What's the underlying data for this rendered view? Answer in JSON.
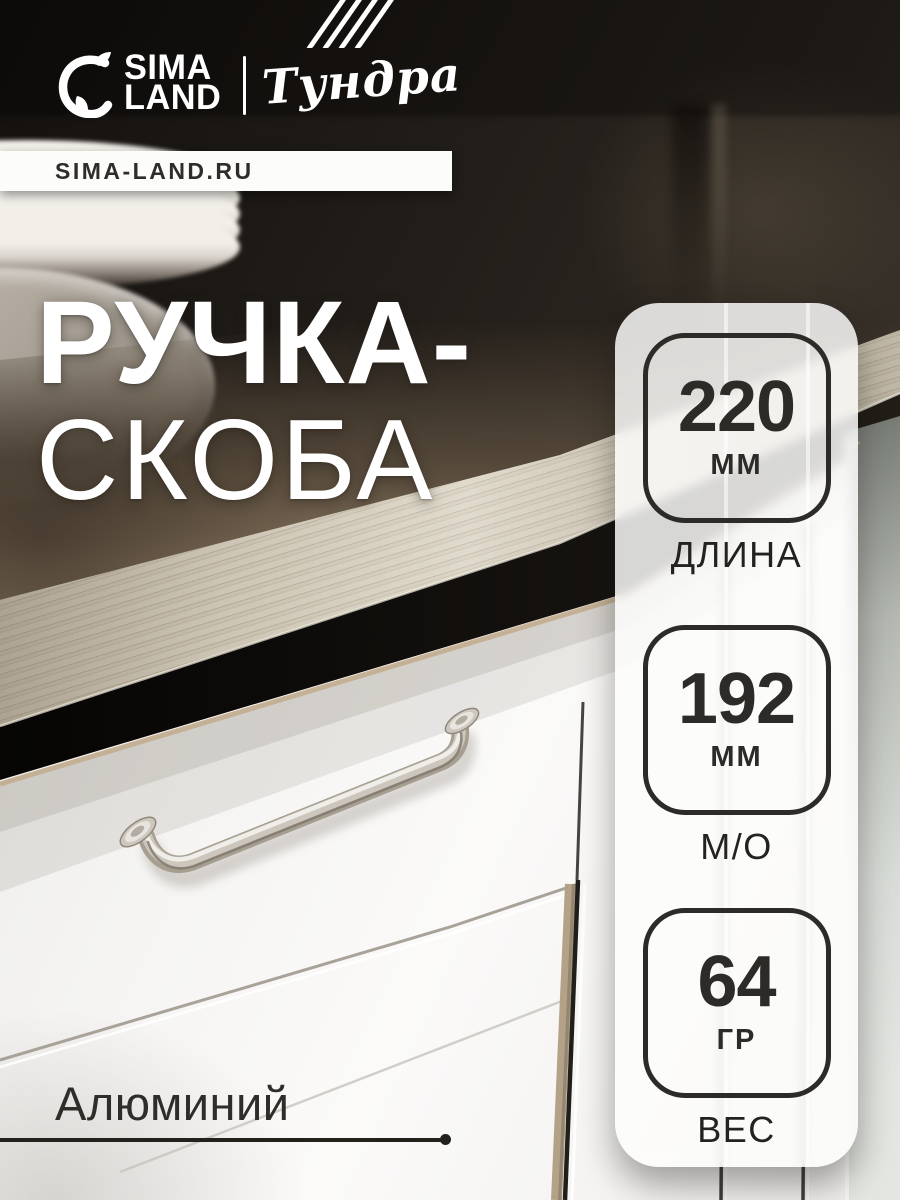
{
  "brand": {
    "logo_line1": "SIMA",
    "logo_line2": "LAND",
    "partner_brand": "Тундра",
    "website": "SIMA-LAND.RU"
  },
  "product": {
    "title_line1": "РУЧКА-",
    "title_line2": "СКОБА",
    "material_label": "Алюминий"
  },
  "specs": [
    {
      "value": "220",
      "unit": "ММ",
      "label": "ДЛИНА"
    },
    {
      "value": "192",
      "unit": "ММ",
      "label": "М/О"
    },
    {
      "value": "64",
      "unit": "ГР",
      "label": "ВЕС"
    }
  ],
  "colors": {
    "spec_text": "#2d2b28",
    "panel_bg": "rgba(253,253,252,0.84)",
    "title_color": "#ffffff",
    "banner_bg": "#fcfcfb",
    "banner_text": "#2f2c29",
    "metal": "#c7c1b8",
    "wood_face": "#cfc7b6",
    "background_dark": "#1f1b17"
  }
}
